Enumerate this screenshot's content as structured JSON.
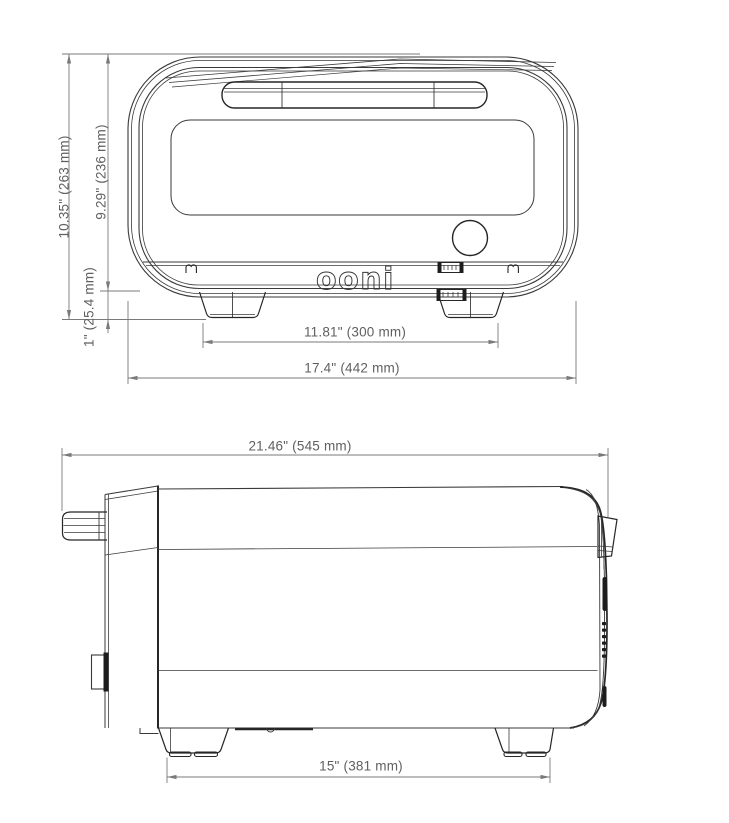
{
  "drawing": {
    "title": "pizza oven dimension drawing",
    "brand_logo": "ooni",
    "front_view": {
      "dimensions": {
        "overall_height": "10.35\" (263 mm)",
        "body_height": "9.29\" (236 mm)",
        "foot_height": "1\" (25.4 mm)",
        "feet_span": "11.81\" (300 mm)",
        "overall_width": "17.4\" (442 mm)"
      }
    },
    "side_view": {
      "dimensions": {
        "overall_depth": "21.46\" (545 mm)",
        "feet_depth": "15\" (381 mm)"
      }
    },
    "colors": {
      "line": "#3a3a3a",
      "dark_line": "#262626",
      "dimension_line": "#7a7a7a",
      "dimension_text": "#606060",
      "background": "#ffffff"
    }
  }
}
